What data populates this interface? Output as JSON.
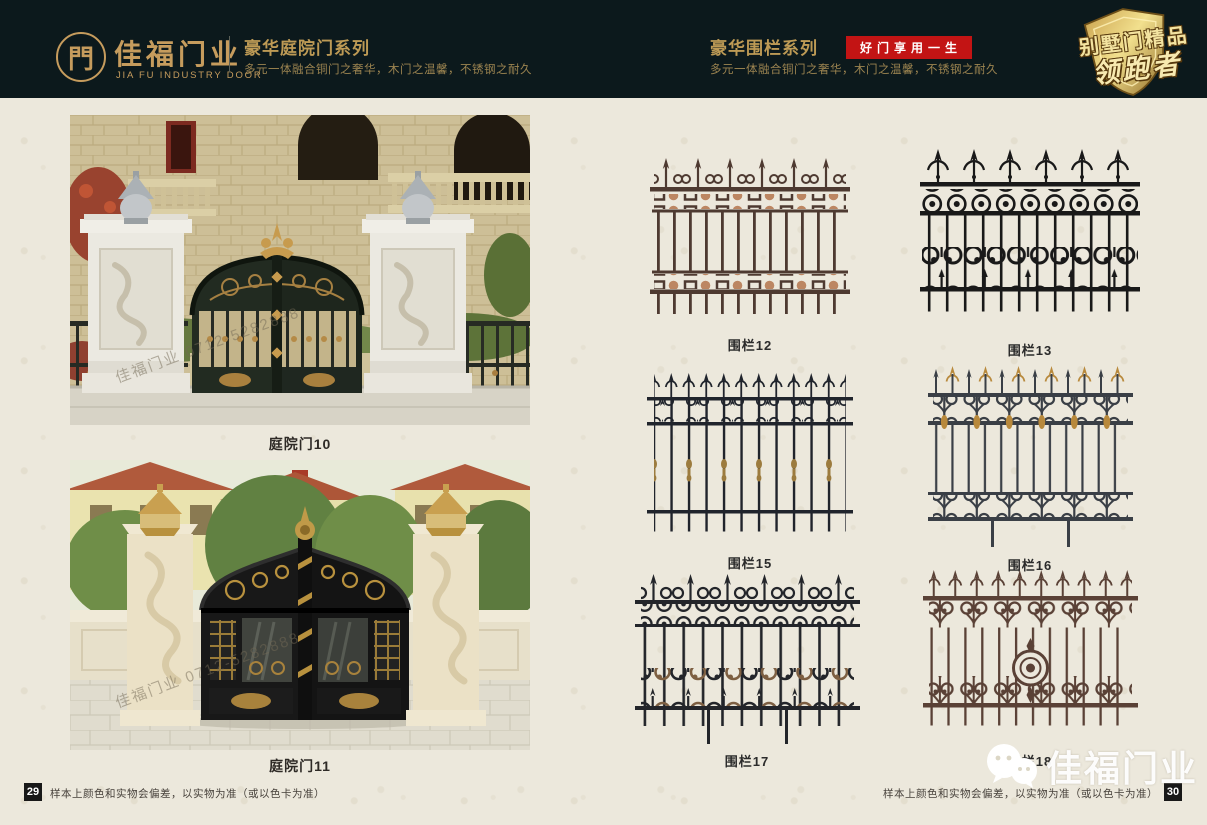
{
  "colors": {
    "header_bg": "#0c191c",
    "gold": "#c69c5d",
    "badge_red": "#c31414",
    "page_bg": "#ece8dc"
  },
  "header": {
    "logo": {
      "glyph": "門",
      "name": "佳福门业",
      "subtitle": "JIA FU INDUSTRY DOOR"
    },
    "door_series": {
      "title": "豪华庭院门系列",
      "subtitle": "多元一体融合铜门之奢华，木门之温馨，不锈钢之耐久"
    },
    "fence_series": {
      "title": "豪华围栏系列",
      "badge": "好门享用一生",
      "subtitle": "多元一体融合铜门之奢华，木门之温馨，不锈钢之耐久"
    },
    "emblem": {
      "line1": "别墅门精品",
      "line2": "领跑者"
    }
  },
  "gates": [
    {
      "label": "庭院门10",
      "watermark": "佳福门业 0712-5282888"
    },
    {
      "label": "庭院门11",
      "watermark": "佳福门业 0712-5282888"
    }
  ],
  "fences": [
    {
      "label": "围栏12",
      "color": "#4e3a31"
    },
    {
      "label": "围栏13",
      "color": "#191919"
    },
    {
      "label": "围栏15",
      "color": "#20242c"
    },
    {
      "label": "围栏16",
      "color": "#3a3f46"
    },
    {
      "label": "围栏17",
      "color": "#23252a"
    },
    {
      "label": "围栏18",
      "color": "#5a4136"
    }
  ],
  "footer": {
    "left_page": "29",
    "right_page": "30",
    "disclaimer": "样本上颜色和实物会偏差，以实物为准（或以色卡为准）",
    "brand_watermark": "佳福门业"
  }
}
